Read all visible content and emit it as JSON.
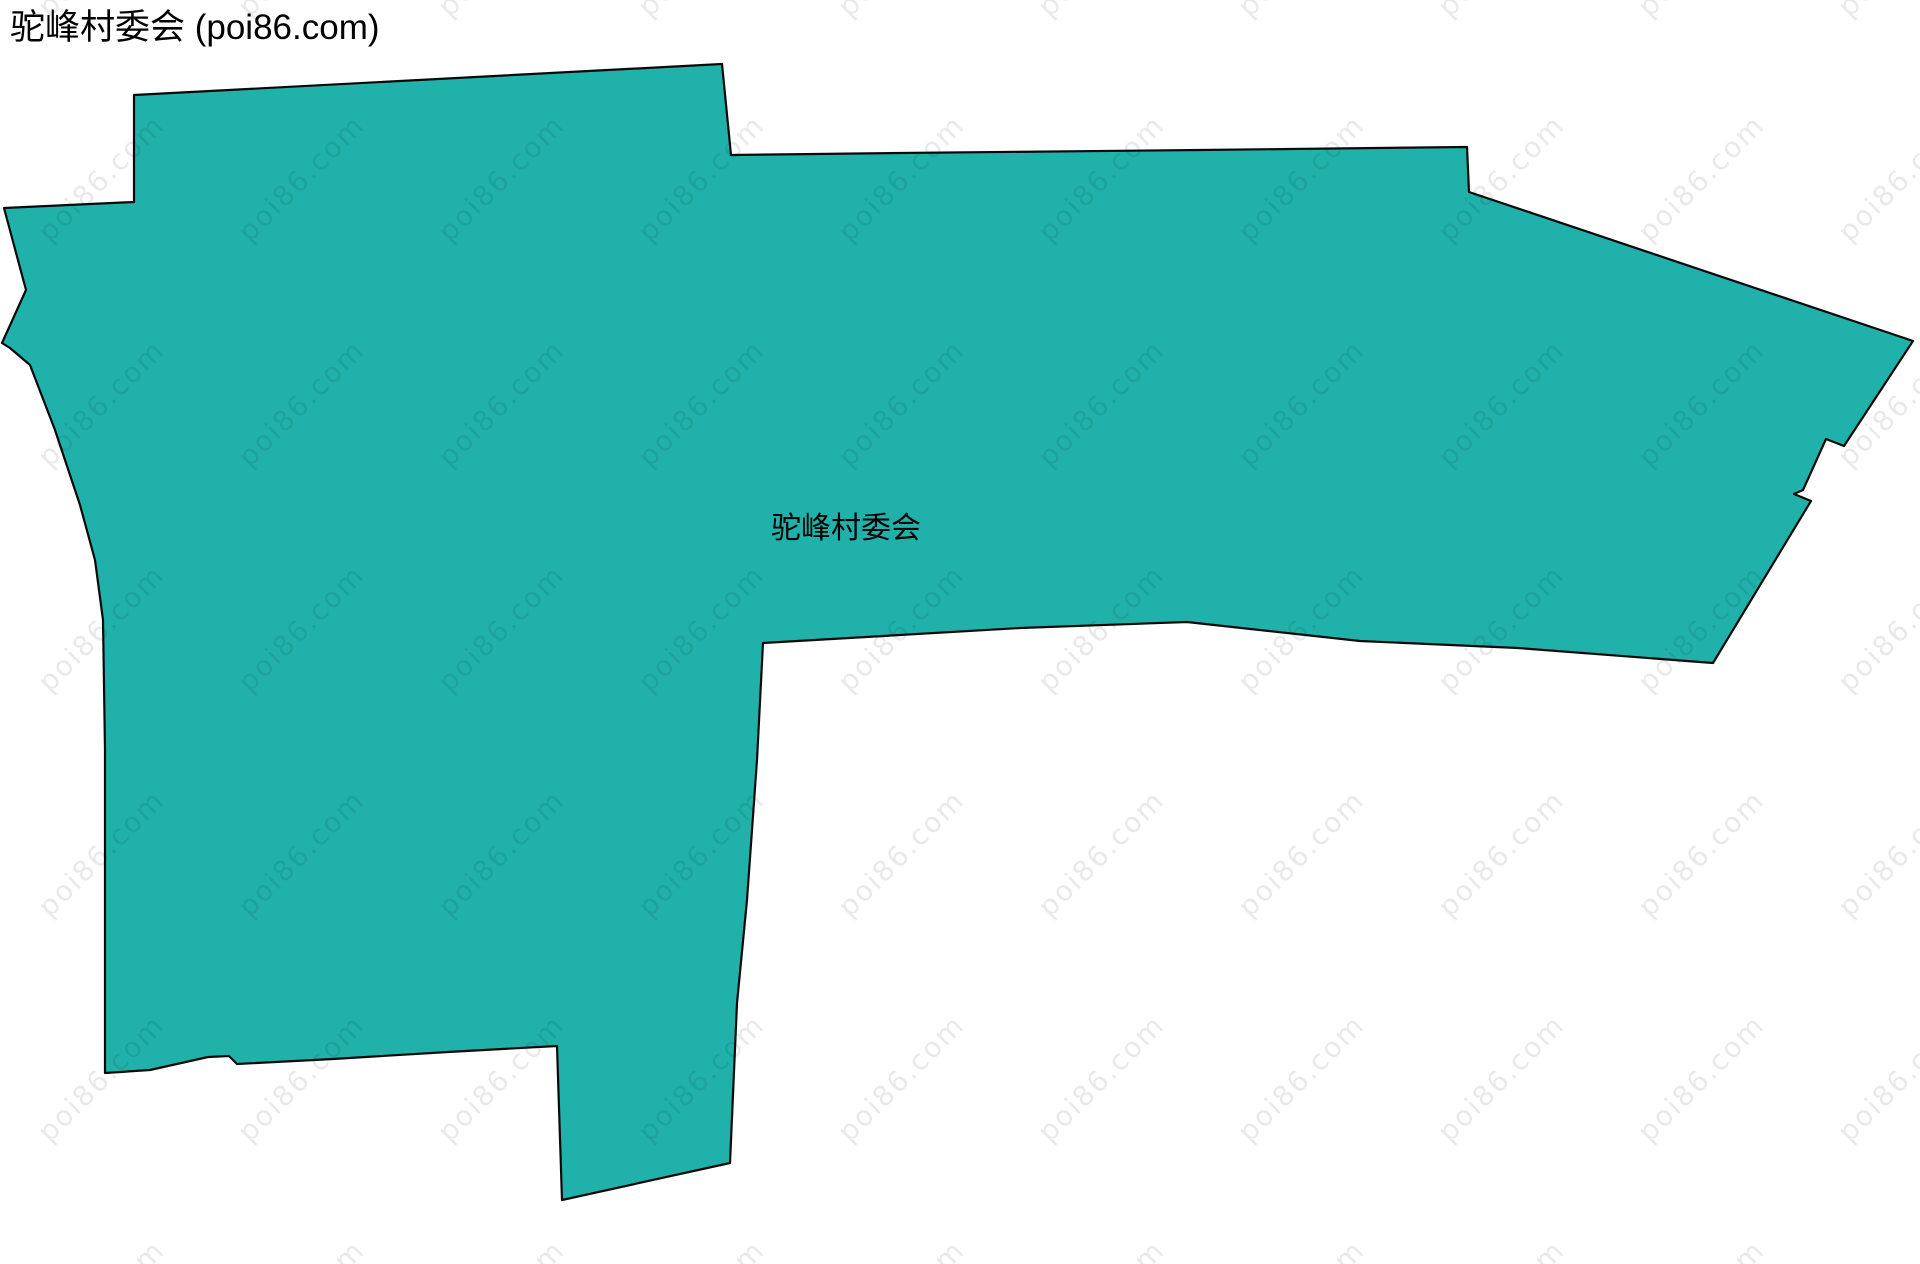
{
  "header": {
    "title": "驼峰村委会 (poi86.com)"
  },
  "map": {
    "region_label": "驼峰村委会",
    "fill_color": "#20b2aa",
    "stroke_color": "#0a0a0a",
    "stroke_width": 2.2,
    "label_x": 846,
    "label_y": 538,
    "polygon_points": "134,95 722,64 731,155 900,153 1200,150 1467,147 1469,192 1913,341 1844,446 1826,439 1803,490 1794,494 1811,501 1713,663 1518,648 1360,641 1187,622 1020,628 763,643 757,760 747,900 737,1003 730,1163 562,1200 557,1046 448,1052 333,1059 237,1064 229,1056 208,1057 150,1070 105,1073 105,750 103,620 95,560 80,505 55,430 30,365 10,348 2,343 26,290 4,208 134,202"
  },
  "watermark": {
    "text": "poi86.com",
    "color": "rgba(0,0,0,0.085)",
    "tile_width": 200,
    "tile_height": 225,
    "offset_x": 8,
    "offset_y": 73,
    "rotation": -45
  },
  "canvas": {
    "width": 1920,
    "height": 1264,
    "background": "#ffffff"
  }
}
